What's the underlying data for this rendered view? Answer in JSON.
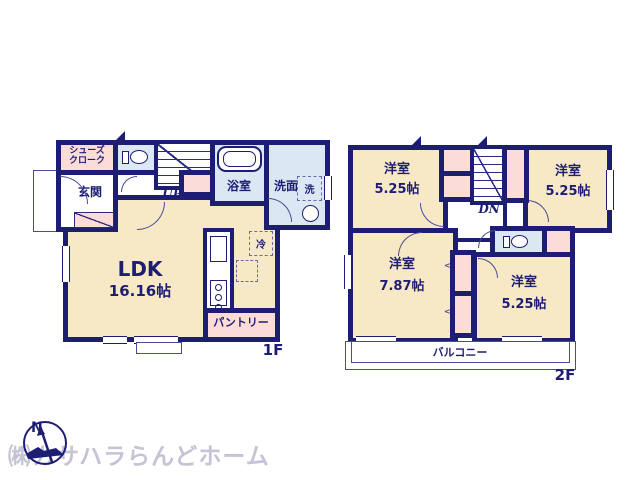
{
  "colors": {
    "wall": "#1d1d73",
    "room_fill": "#f8e9c6",
    "closet_fill": "#fbdcd7",
    "wet_area_fill": "#dbe8f4",
    "watermark": "#c4c4d6"
  },
  "compass": {
    "label": "N"
  },
  "watermark": {
    "company": "㈱カサハラらんどホーム"
  },
  "floor1": {
    "floor_label": "1F",
    "shoes_closet_line1": "シューズ",
    "shoes_closet_line2": "クローク",
    "entrance": "玄関",
    "stairs": "UP",
    "bathroom": "浴室",
    "washroom": "洗面",
    "laundry": "洗",
    "fridge": "冷",
    "ldk_name": "LDK",
    "ldk_size": "16.16帖",
    "pantry": "パントリー"
  },
  "floor2": {
    "floor_label": "2F",
    "stairs": "DN",
    "balcony": "バルコニー",
    "room_top_left": {
      "name": "洋室",
      "size": "5.25帖"
    },
    "room_top_right": {
      "name": "洋室",
      "size": "5.25帖"
    },
    "room_bottom_left": {
      "name": "洋室",
      "size": "7.87帖"
    },
    "room_bottom_right": {
      "name": "洋室",
      "size": "5.25帖"
    }
  }
}
